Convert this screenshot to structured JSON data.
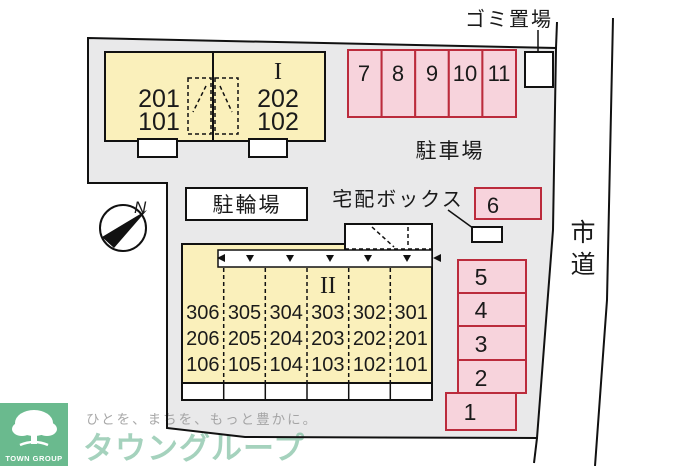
{
  "plan": {
    "north_label": "N",
    "labels": {
      "garbage": "ゴミ置場",
      "parking_lot": "駐車場",
      "bicycle": "駐輪場",
      "delivery_box": "宅配ボックス"
    },
    "road_label_chars": [
      "市",
      "道"
    ],
    "building1": {
      "name": "I",
      "left_units": [
        "201",
        "101"
      ],
      "right_units": [
        "202",
        "102"
      ]
    },
    "building2": {
      "name": "II",
      "rows": [
        [
          "306",
          "305",
          "304",
          "303",
          "302",
          "301"
        ],
        [
          "206",
          "205",
          "204",
          "203",
          "202",
          "201"
        ],
        [
          "106",
          "105",
          "104",
          "103",
          "102",
          "101"
        ]
      ]
    },
    "parking_top": [
      "7",
      "8",
      "9",
      "10",
      "11"
    ],
    "parking_right": [
      "5",
      "4",
      "3",
      "2",
      "1"
    ],
    "parking_six": "6"
  },
  "footer": {
    "logo_text": "TOWN GROUP",
    "tagline": "ひとを、まちを、もっと豊かに。",
    "brand": "タウングループ"
  },
  "colors": {
    "site_fill": "#e9e9ea",
    "building_fill": "#faf0bb",
    "stall_fill": "#f7d3dc",
    "stall_border": "#bb2b3c",
    "line": "#111111",
    "logo_green": "#6aba8e",
    "brand_green": "#6fb795",
    "tagline_gray": "#999999"
  }
}
